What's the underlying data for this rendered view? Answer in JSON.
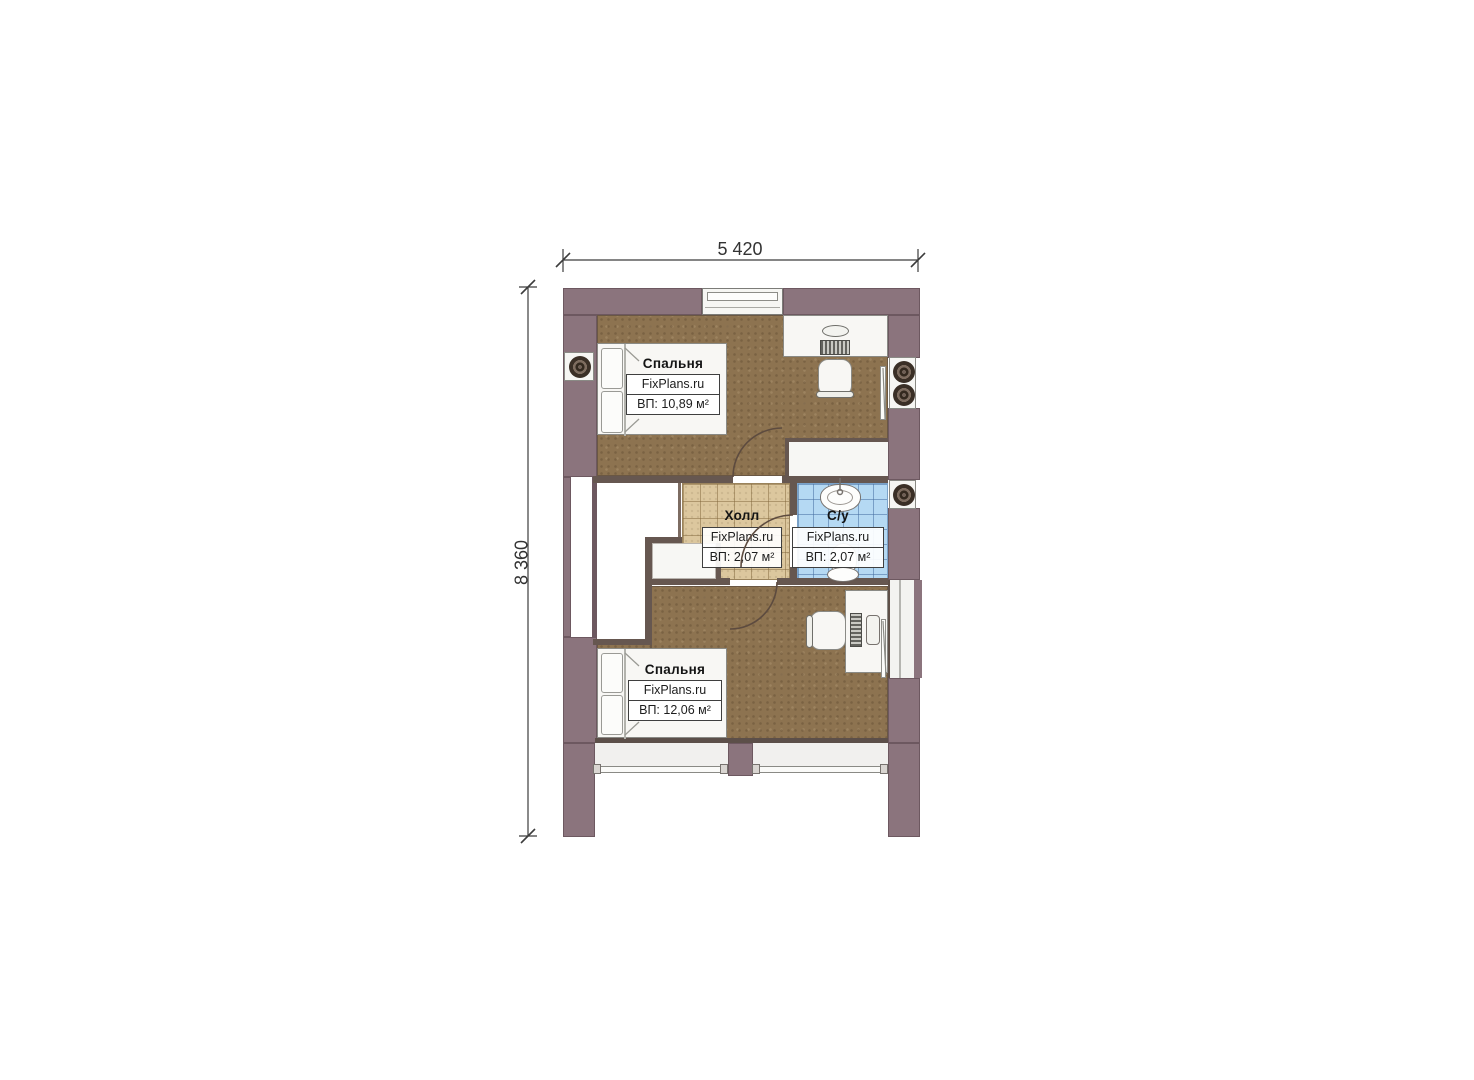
{
  "dimensions": {
    "width_label": "5 420",
    "height_label": "8 360"
  },
  "rooms": {
    "bedroom_top": {
      "name": "Спальня",
      "brand": "FixPlans.ru",
      "area": "ВП: 10,89 м²"
    },
    "hall": {
      "name": "Холл",
      "brand": "FixPlans.ru",
      "area": "ВП: 2,07 м²"
    },
    "bathroom": {
      "name": "С/у",
      "brand": "FixPlans.ru",
      "area": "ВП: 2,07 м²"
    },
    "bedroom_bottom": {
      "name": "Спальня",
      "brand": "FixPlans.ru",
      "area": "ВП: 12,06 м²"
    }
  },
  "colors": {
    "exterior_wall": "#8b747d",
    "interior_wall": "#665750",
    "wood_floor": "#8d7350",
    "hall_tile": "#dcc79e",
    "bath_tile": "#b5d9f3",
    "dimension_line": "#3c3c3c"
  }
}
